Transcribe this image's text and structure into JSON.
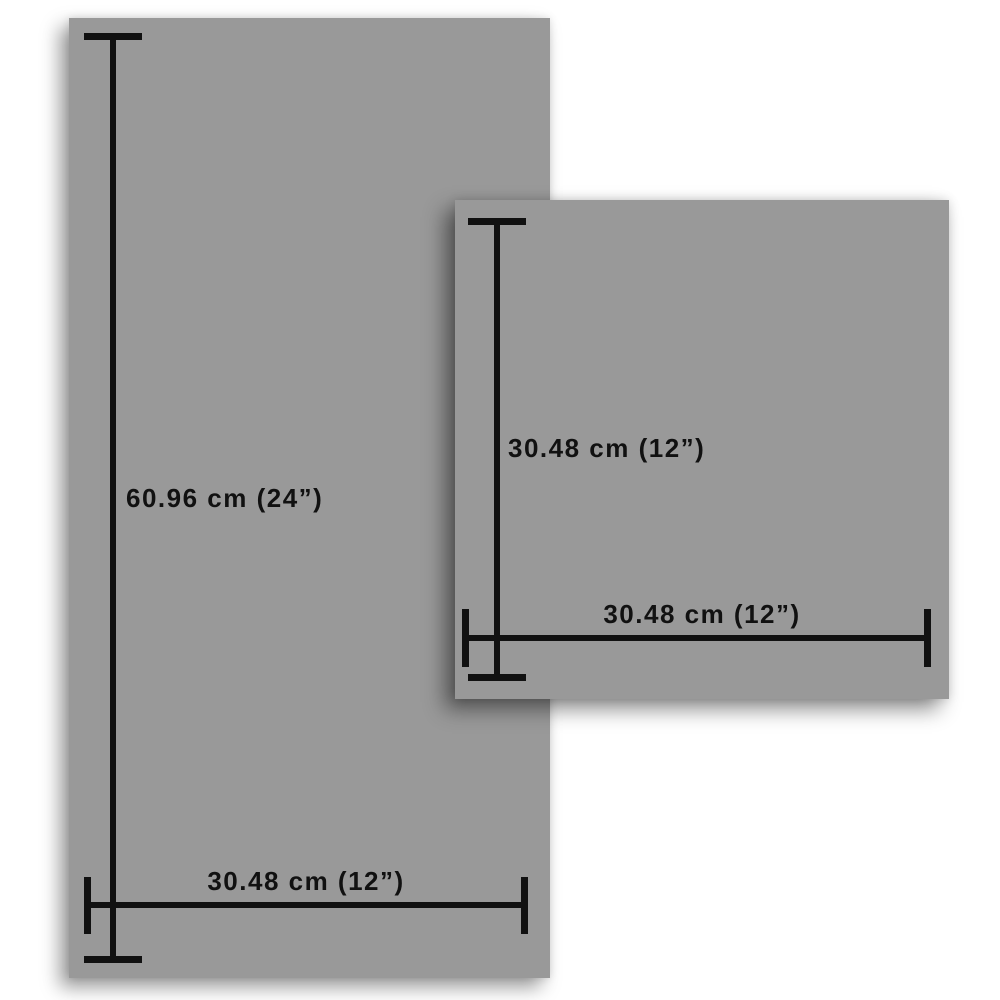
{
  "big_panel": {
    "height_label": "60.96 cm (24”)",
    "width_label": "30.48 cm (12”)"
  },
  "small_panel": {
    "height_label": "30.48 cm (12”)",
    "width_label": "30.48 cm (12”)"
  },
  "colors": {
    "panel_gray": "#999999",
    "dimension_black": "#111111",
    "background": "#ffffff"
  }
}
